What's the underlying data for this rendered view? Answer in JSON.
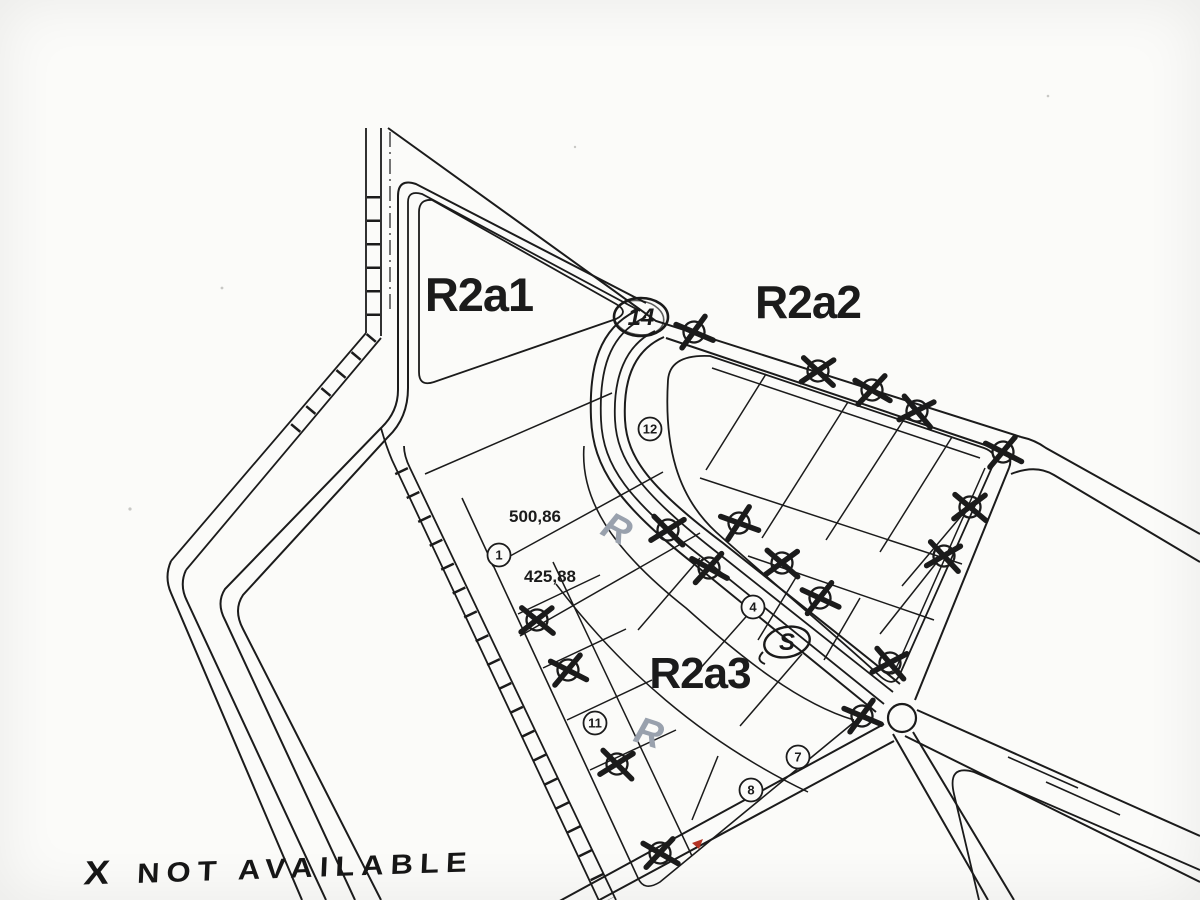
{
  "paper": {
    "background": "#fbfbf9",
    "ink": "#1b1b1b",
    "pencil": "#99a1ad",
    "red": "#b43425"
  },
  "zones": [
    {
      "label": "R2a1",
      "x": 479,
      "y": 311,
      "size": 47
    },
    {
      "label": "R2a2",
      "x": 808,
      "y": 318,
      "size": 46
    },
    {
      "label": "R2a3",
      "x": 700,
      "y": 688,
      "size": 44
    }
  ],
  "measurements": [
    {
      "value": "500,86",
      "x": 535,
      "y": 522
    },
    {
      "value": "425,88",
      "x": 550,
      "y": 582
    }
  ],
  "plot_circles": [
    {
      "label": "12",
      "x": 650,
      "y": 429
    },
    {
      "label": "1",
      "x": 499,
      "y": 555
    },
    {
      "label": "4",
      "x": 753,
      "y": 607
    },
    {
      "label": "11",
      "x": 595,
      "y": 723
    },
    {
      "label": "7",
      "x": 798,
      "y": 757
    },
    {
      "label": "8",
      "x": 751,
      "y": 790
    }
  ],
  "handwritten": {
    "circled_14": {
      "label": "14",
      "x": 641,
      "y": 317
    },
    "circled_s": {
      "label": "S",
      "x": 787,
      "y": 642
    },
    "pencil_marks": [
      {
        "label": "R",
        "x": 611,
        "y": 540,
        "rotate": 28
      },
      {
        "label": "R",
        "x": 645,
        "y": 745,
        "rotate": 18
      }
    ],
    "legend": {
      "symbol": "X",
      "text": "NOT AVAILABLE"
    }
  },
  "not_available_markers": [
    {
      "x": 694,
      "y": 332
    },
    {
      "x": 818,
      "y": 371
    },
    {
      "x": 872,
      "y": 390
    },
    {
      "x": 917,
      "y": 411
    },
    {
      "x": 1003,
      "y": 452
    },
    {
      "x": 970,
      "y": 507
    },
    {
      "x": 944,
      "y": 556
    },
    {
      "x": 739,
      "y": 523
    },
    {
      "x": 782,
      "y": 563
    },
    {
      "x": 820,
      "y": 598
    },
    {
      "x": 668,
      "y": 530
    },
    {
      "x": 709,
      "y": 568
    },
    {
      "x": 890,
      "y": 663
    },
    {
      "x": 862,
      "y": 716
    },
    {
      "x": 537,
      "y": 620
    },
    {
      "x": 568,
      "y": 670
    },
    {
      "x": 617,
      "y": 764
    },
    {
      "x": 660,
      "y": 853
    }
  ],
  "red_mark": {
    "x": 692,
    "y": 843
  },
  "roundabout": {
    "x": 902,
    "y": 718,
    "r": 14
  }
}
